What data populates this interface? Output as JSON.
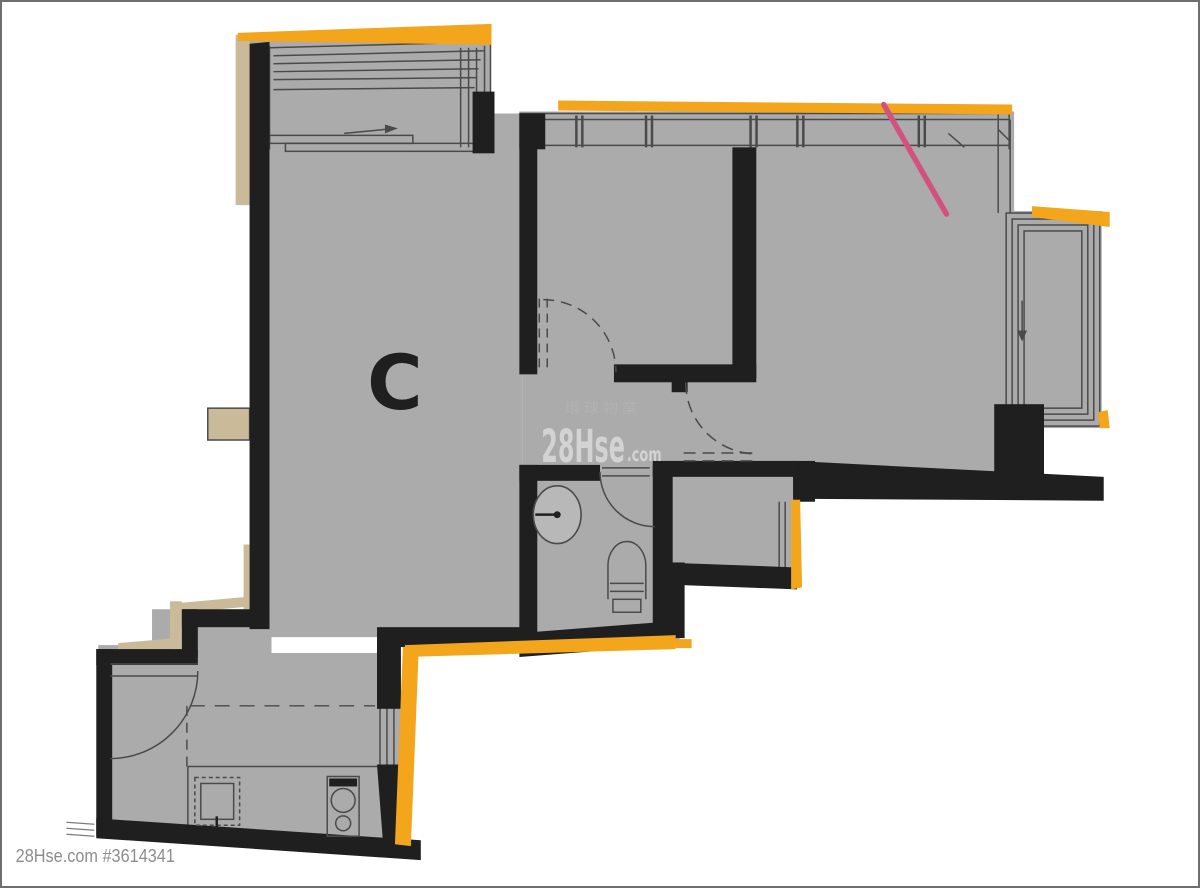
{
  "unit": {
    "label": "C"
  },
  "watermark": {
    "brand": "28Hse",
    "tld": ".com",
    "agency": "環球物業"
  },
  "footer": {
    "credit": "28Hse.com #3614341"
  },
  "palette": {
    "bg": "#ffffff",
    "border": "#6f6f6f",
    "floor": "#ababab",
    "floorlight": "#b8b8b8",
    "wall": "#1f1f1f",
    "line": "#4a4a4a",
    "linesoft": "#7c7c7c",
    "orange": "#f3a51c",
    "tan": "#cbba99",
    "pink": "#d2517f",
    "watermark": "#dadada",
    "watermarkfaint": "#b9b9b9",
    "credit": "#8d8d8d"
  }
}
